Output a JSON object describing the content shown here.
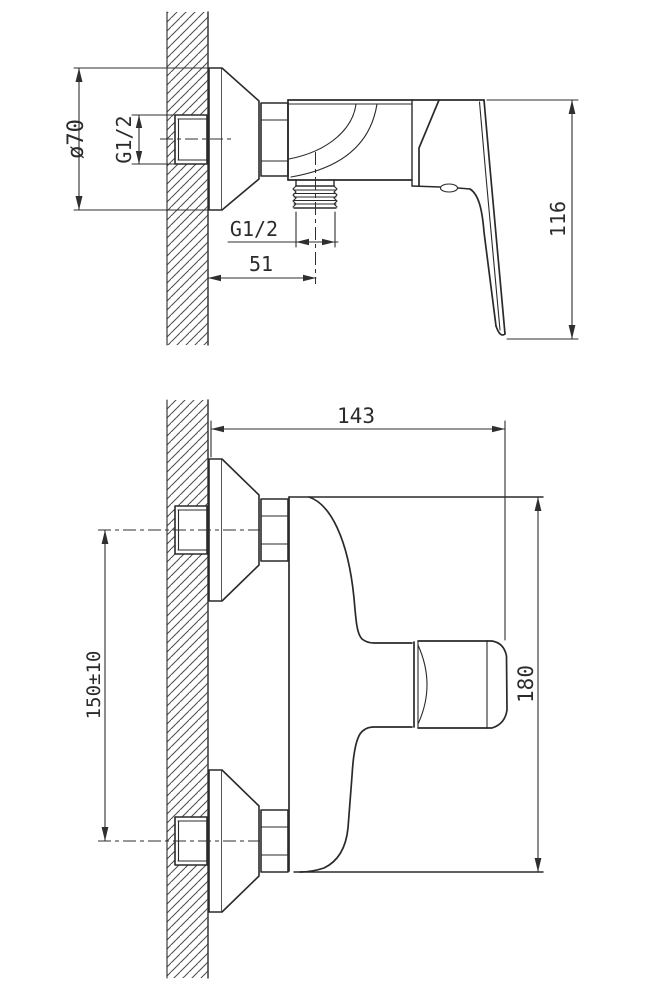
{
  "drawing": {
    "background": "#ffffff",
    "line_color": "#2a2a2a",
    "dim_color": "#2f2f2f",
    "hatch_color": "#4a4a4a",
    "top_view": {
      "labels": {
        "flange_diameter": "ø70",
        "inlet_thread": "G1/2",
        "outlet_thread": "G1/2",
        "wall_to_outlet": "51",
        "handle_height": "116"
      }
    },
    "front_view": {
      "labels": {
        "depth": "143",
        "connection_spacing": "150±10",
        "overall_height": "180"
      }
    }
  }
}
